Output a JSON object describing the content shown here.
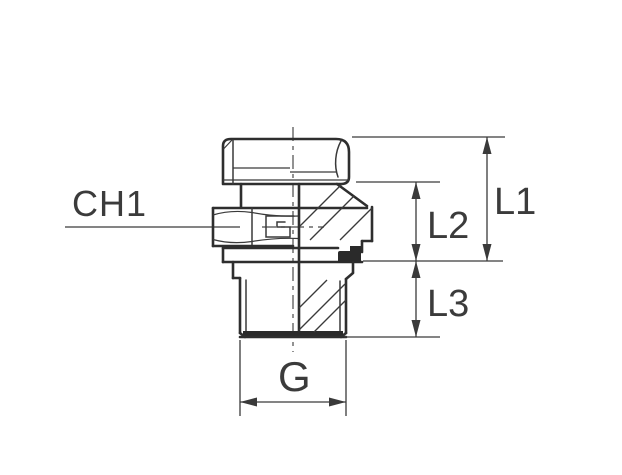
{
  "drawing": {
    "kind": "technical-drawing",
    "subject": "male stud hydraulic fitting, half-section side view",
    "background_color": "#ffffff",
    "line_color": "#2e2e2e",
    "dimension_color": "#3a3a3a",
    "text_color": "#3b3b3b",
    "seal_fill_color": "#2a2a2a"
  },
  "labels": {
    "ch1": "CH1",
    "l1": "L1",
    "l2": "L2",
    "l3": "L3",
    "g": "G"
  },
  "dimensions": [
    {
      "id": "CH1",
      "type": "callout-leader",
      "orientation": "horizontal"
    },
    {
      "id": "L1",
      "type": "linear",
      "orientation": "vertical"
    },
    {
      "id": "L2",
      "type": "linear",
      "orientation": "vertical"
    },
    {
      "id": "L3",
      "type": "linear",
      "orientation": "vertical"
    },
    {
      "id": "G",
      "type": "linear",
      "orientation": "horizontal"
    }
  ]
}
